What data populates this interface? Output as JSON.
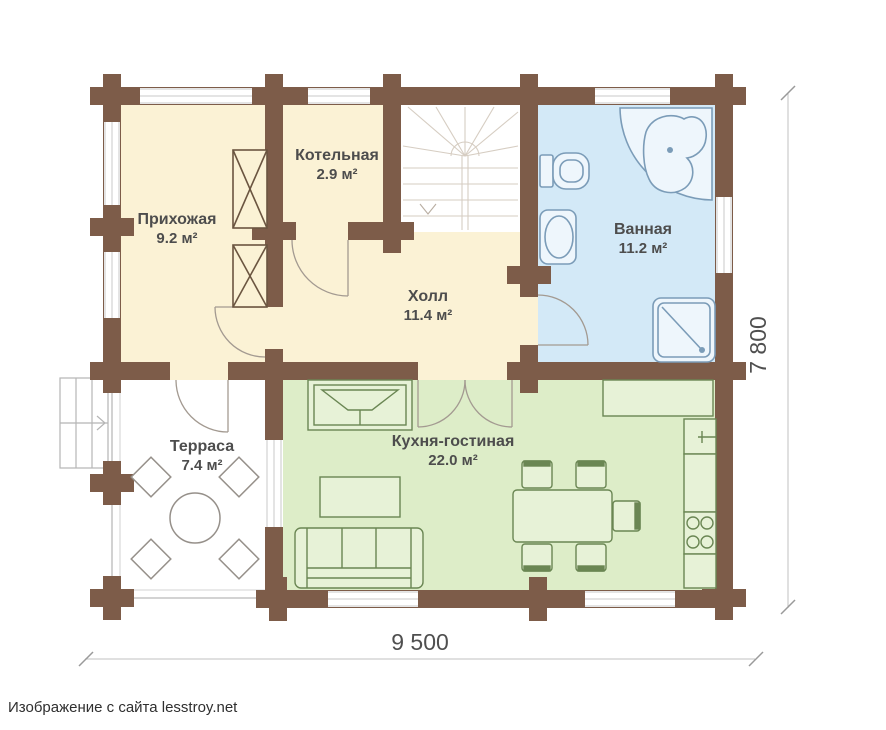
{
  "caption": "Изображение с сайта lesstroy.net",
  "plan": {
    "type": "floor-plan",
    "dimensions": {
      "width_label": "9 500",
      "height_label": "7 800"
    },
    "rooms": {
      "hallway": {
        "label": "Прихожая",
        "area": "9.2 м²",
        "fill": "#fbf2d5"
      },
      "boiler": {
        "label": "Котельная",
        "area": "2.9 м²",
        "fill": "#fbf2d5"
      },
      "hall": {
        "label": "Холл",
        "area": "11.4 м²",
        "fill": "#fbf2d5"
      },
      "bathroom": {
        "label": "Ванная",
        "area": "11.2 м²",
        "fill": "#d3e9f7"
      },
      "terrace": {
        "label": "Терраса",
        "area": "7.4 м²",
        "fill": "#ffffff"
      },
      "kitchen_living": {
        "label": "Кухня-гостиная",
        "area": "22.0 м²",
        "fill": "#ddedc8"
      }
    },
    "features": {
      "bathroom": [
        "corner-bathtub",
        "toilet",
        "sink",
        "shower"
      ],
      "kitchen_living": [
        "fireplace",
        "sofa",
        "coffee-table",
        "dining-table",
        "chairs",
        "kitchen-counter",
        "kitchen-sink",
        "stove"
      ],
      "terrace": [
        "round-table",
        "chairs",
        "entry-steps"
      ],
      "hall": [
        "winder-staircase"
      ]
    },
    "colors": {
      "wall": "#7d5c49",
      "room_cream": "#fbf2d5",
      "room_blue": "#d3e9f7",
      "room_green": "#ddedc8",
      "label_text": "#4d4d4d",
      "kitchen_furniture_stroke": "#6a8653",
      "bath_fixture_stroke": "#7b9cb8",
      "terrace_furniture_stroke": "#96908a",
      "stairs_stroke": "#d6cdc2",
      "dimension_line": "#bdbdbd",
      "dimension_text": "#4f4f4f"
    }
  }
}
